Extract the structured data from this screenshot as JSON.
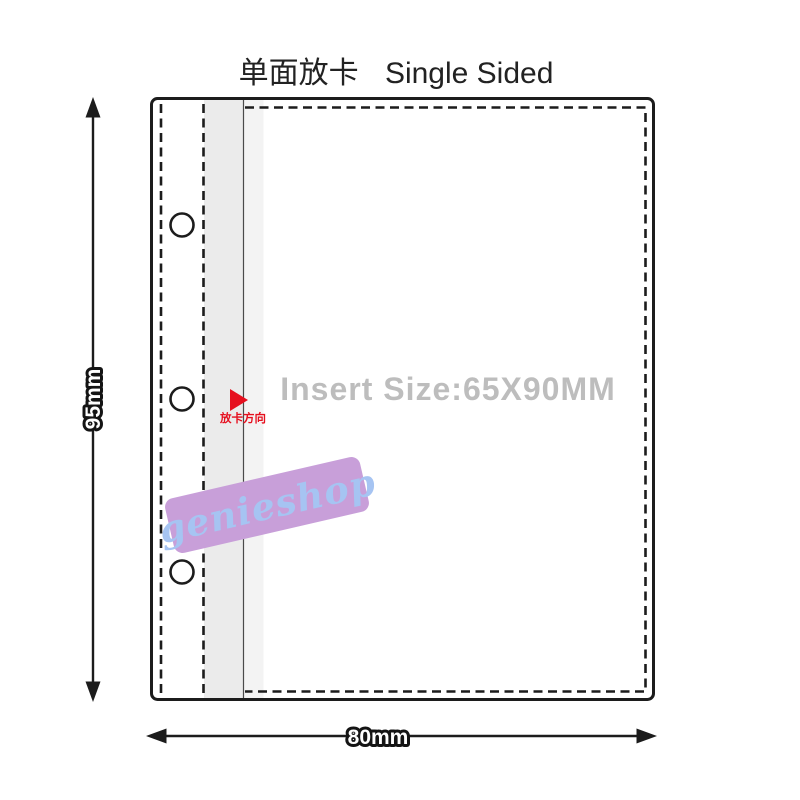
{
  "title": {
    "zh": "单面放卡",
    "en": "Single Sided"
  },
  "dimensions": {
    "height_label": "95mm",
    "width_label": "80mm"
  },
  "pocket": {
    "insert_size_label": "Insert Size:65X90MM",
    "insert_direction_label": "放卡方向"
  },
  "watermark": {
    "text": "genieshop"
  },
  "colors": {
    "outline": "#1c1c1c",
    "insert_size_text": "#bdbdbd",
    "accent_red": "#e60f1e",
    "watermark_bg": "#c89fd9",
    "watermark_text": "#a6c4f2",
    "strip_gray": "#ebebeb",
    "strip_gray_light": "#f3f3f3",
    "thin_line": "#4a4a4a"
  }
}
